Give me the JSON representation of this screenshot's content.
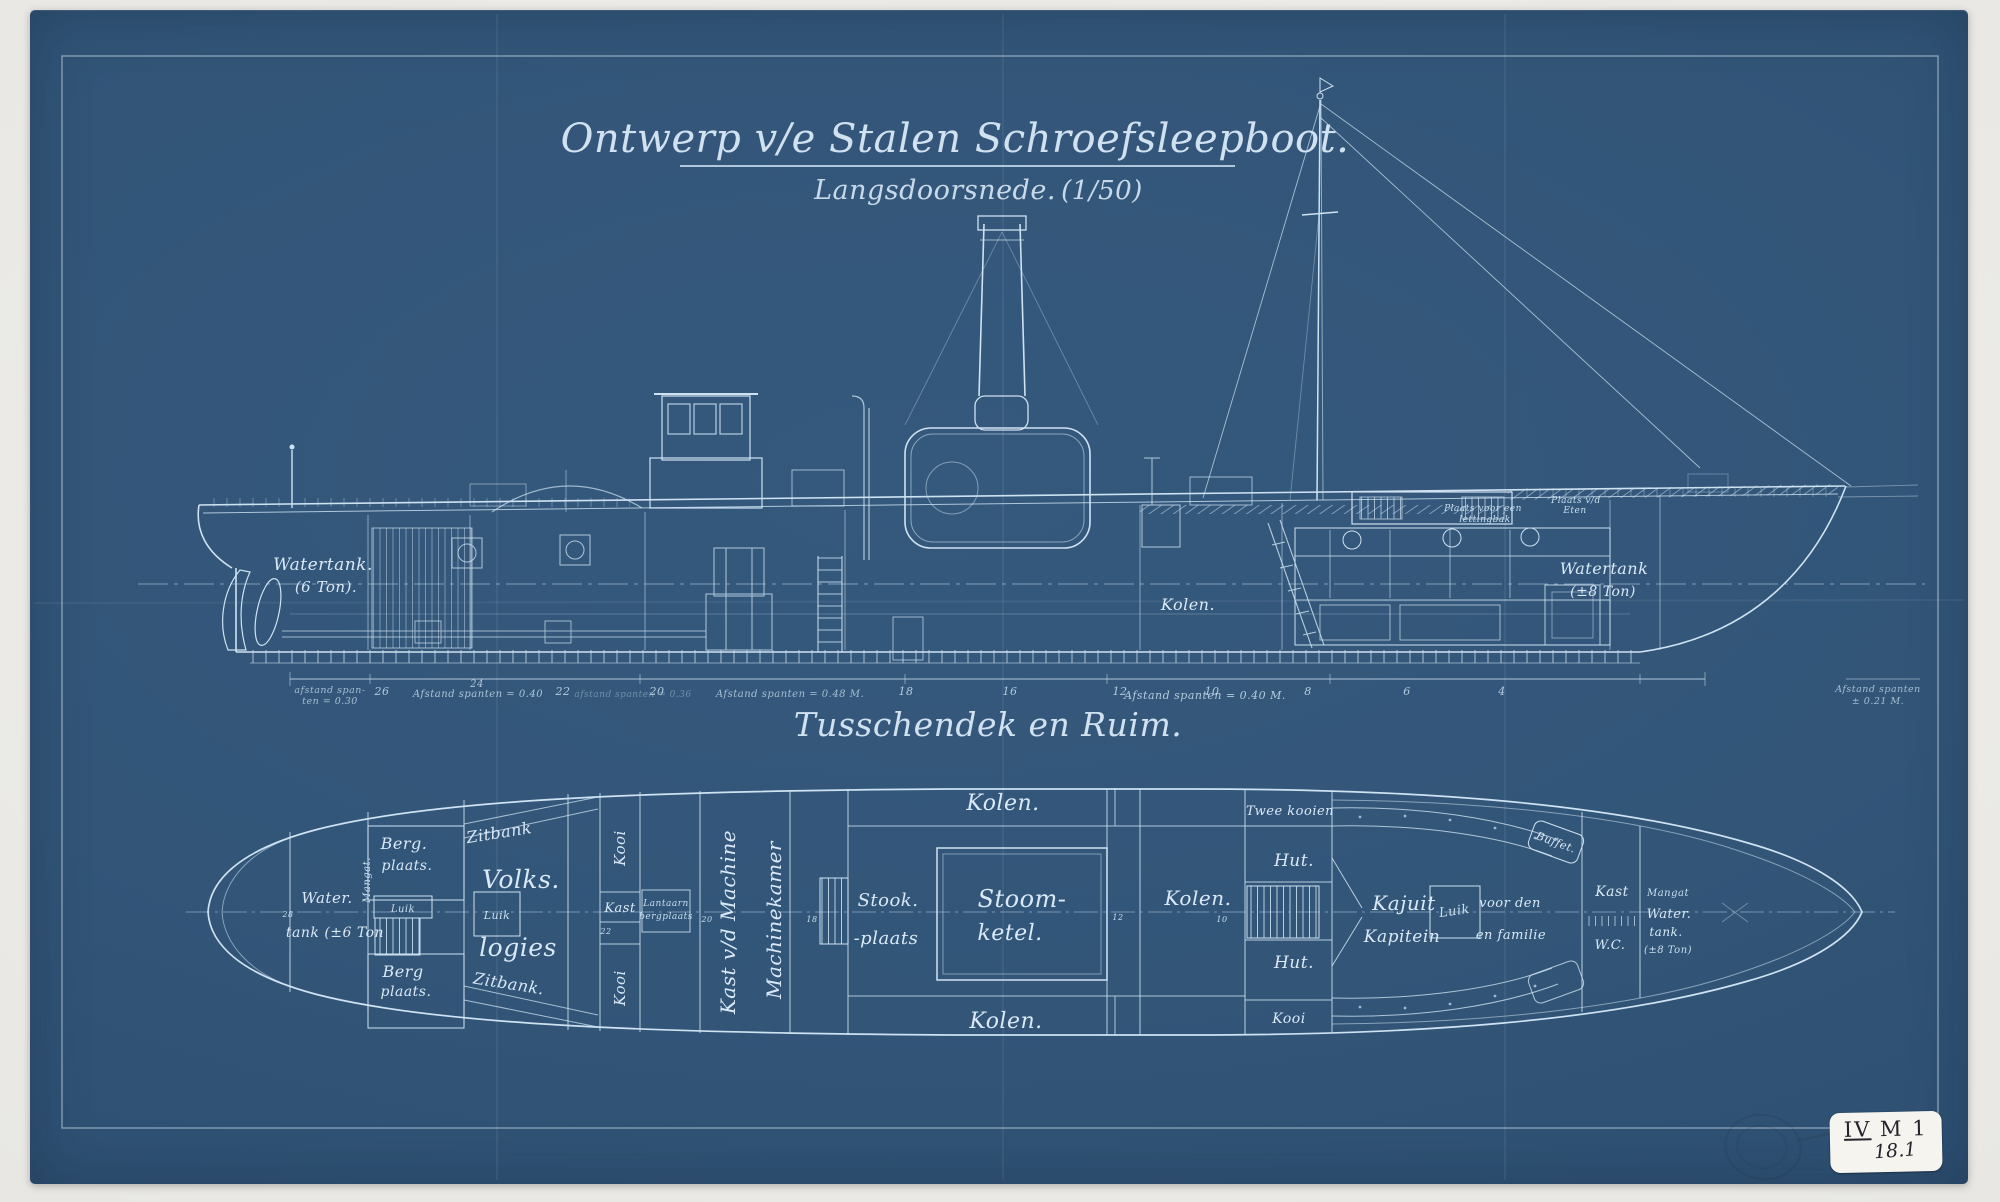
{
  "title_block": {
    "title": "Ontwerp v/e Stalen Schroefsleepboot.",
    "subtitle": "Langsdoorsnede.",
    "scale": "(1/50)"
  },
  "section2_title": "Tusschendek en Ruim.",
  "colors": {
    "paper_blue": "#315478",
    "line_white": "#cfe2f2",
    "margin_gray": "#e8e7e3",
    "sticker_white": "#f6f4ee"
  },
  "side_view": {
    "watertank_aft1": "Watertank.",
    "watertank_aft2": "(6 Ton).",
    "kolen": "Kolen.",
    "watertank_fore1": "Watertank",
    "watertank_fore2": "(±8 Ton)",
    "deck_note_a1": "Plaats voor een",
    "deck_note_a2": "lettingbak",
    "deck_note_b1": "Plaats v/d",
    "deck_note_b2": "Eten",
    "frames": [
      "26",
      "24",
      "22",
      "20",
      "18",
      "16",
      "12",
      "10",
      "8",
      "6",
      "4"
    ],
    "dim_notes": {
      "aft1": "afstand span-",
      "aft2": "ten = 0.30",
      "n040a": "Afstand spanten = 0.40",
      "n036": "afstand spanten = 0.36",
      "n048": "Afstand spanten = 0.48 M.",
      "n040b": "Afstand spanten = 0.40 M.",
      "bow1": "Afstand spanten",
      "bow2": "± 0.21 M."
    }
  },
  "deck_plan": {
    "water1": "Water.",
    "water2": "tank (±6 Ton",
    "frame28": "28",
    "mangat_aft": "Mangat.",
    "berg_top1": "Berg.",
    "berg_top2": "plaats.",
    "luik_aft": "Luik",
    "berg_bot1": "Berg",
    "berg_bot2": "plaats.",
    "zitbank_top": "Zitbank",
    "zitbank_bot": "Zitbank.",
    "volks": "Volks.",
    "luik_volks": "Luik",
    "logies": "logies",
    "kooi_top": "Kooi",
    "kast_left": "Kast",
    "frame22": "22",
    "lantaarn1": "Lantaarn",
    "lantaarn2": "bergplaats",
    "kooi_bot": "Kooi",
    "kast_machine": "Kast v/d Machine",
    "machinekamer": "Machinekamer",
    "frame20": "20",
    "frame18": "18",
    "frame12": "12",
    "frame10": "10",
    "kolen_top": "Kolen.",
    "stook1": "Stook.",
    "stook2": "-plaats",
    "stoom1": "Stoom-",
    "stoom2": "ketel.",
    "kolen_right": "Kolen.",
    "kolen_bottom": "Kolen.",
    "twee_kooien": "Twee kooien",
    "hut_top": "Hut.",
    "hut_bot": "Hut.",
    "kooi_right": "Kooi",
    "kajuit": "Kajuit",
    "kapitein": "Kapitein",
    "luik_mid": "Luik",
    "voor_den": "voor den",
    "en_familie": "en familie",
    "buffet": "Buffet.",
    "kast_right": "Kast",
    "wc": "W.C.",
    "mangat1": "Mangat",
    "mangat2": "Water.",
    "mangat3": "tank.",
    "mangat4": "(±8 Ton)"
  },
  "sticker": {
    "roman": "IV",
    "rest": "M 1",
    "number": "18.1"
  }
}
